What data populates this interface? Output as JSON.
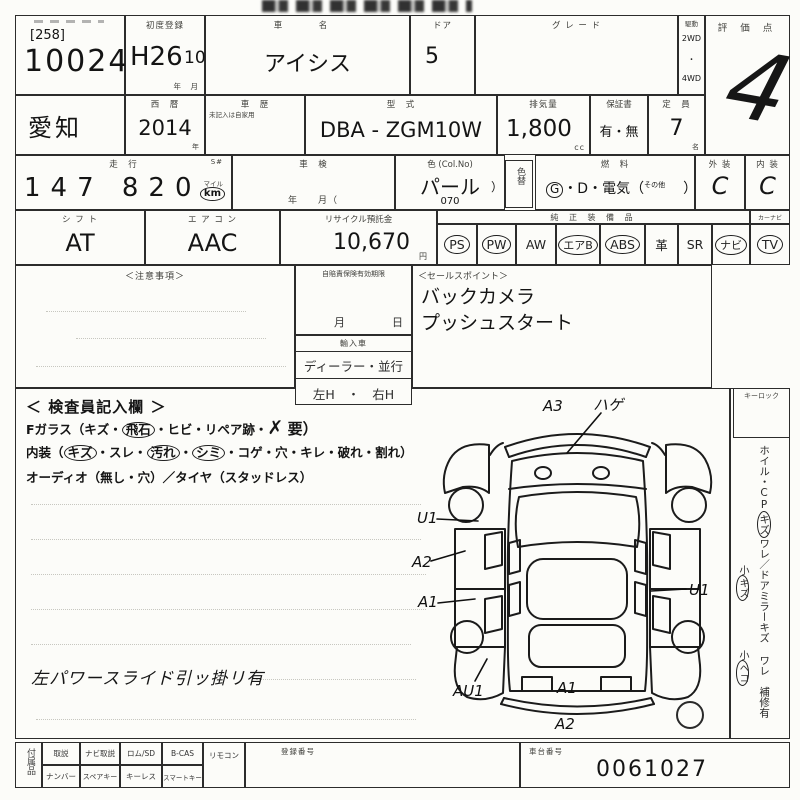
{
  "top": {
    "lot_small": "[258]",
    "lot": "10024",
    "first_reg_label": "初度登録",
    "first_reg_era": "H26",
    "first_reg_month": "10",
    "first_reg_units": "年　月",
    "car_name_label": "車　名",
    "car_name": "アイシス",
    "door_label": "ドア",
    "door": "5",
    "grade_label": "グ レ ー ド",
    "drive_label": "駆動",
    "drive_2wd": "2WD",
    "drive_dot": "・",
    "drive_4wd": "4WD",
    "score_label": "評 価 点",
    "score": "4"
  },
  "row2": {
    "region": "愛知",
    "year_label": "西　暦",
    "year": "2014",
    "year_unit": "年",
    "history_label": "車　歴",
    "history_note": "未記入は自家用",
    "model_label": "型　式",
    "model": "DBA - ZGM10W",
    "cc_label": "排気量",
    "cc": "1,800",
    "cc_unit": "cc",
    "warranty_label": "保証書",
    "warranty": "有・無",
    "capacity_label": "定　員",
    "capacity": "7",
    "capacity_unit": "名"
  },
  "row3": {
    "mileage_label": "走　行",
    "s_label": "S#",
    "mileage": "147 820",
    "mile_small": "マイル",
    "km": "km",
    "shaken_label": "車　検",
    "shaken_units": "年　　月（",
    "color_label": "色 (Col.No)",
    "color": "パール",
    "color_no": "070",
    "color_paren": "）",
    "colorchg_label": "色替",
    "fuel_label": "燃　料",
    "fuel_g": "G",
    "fuel_rest": "・D・電気（",
    "fuel_other": "その他",
    "fuel_close": "）",
    "ext_label": "外 装",
    "ext": "C",
    "int_label": "内 装",
    "int": "C"
  },
  "row4": {
    "shift_label": "シ フ ト",
    "shift": "AT",
    "ac_label": "エ ア コ ン",
    "ac": "AAC",
    "recycle_label": "リサイクル預託金",
    "recycle": "10,670",
    "recycle_unit": "円",
    "equip_label": "純 正 装 備 品",
    "equip_extra_label": "カーナビ",
    "equip": [
      "PS",
      "PW",
      "AW",
      "エアB",
      "ABS",
      "革",
      "SR",
      "ナビ",
      "TV"
    ]
  },
  "mid": {
    "notes_label": "＜注意事項＞",
    "expiry_label": "自賠責保険有効期限",
    "expiry_month": "月",
    "expiry_day": "日",
    "import_label": "輸入車",
    "import_opts": "ディーラー・並行",
    "import_handle": "左H　・　右H",
    "sales_label": "＜セールスポイント＞",
    "sales_1": "バックカメラ",
    "sales_2": "プッシュスタート"
  },
  "inspector": {
    "title": "＜ 検査員記入欄 ＞",
    "fglass_pre": "Fガラス（キズ・",
    "fglass_c1": "飛石",
    "fglass_mid": "・ヒビ・リペア跡・",
    "fglass_x": "✗",
    "fglass_end": "要）",
    "interior_pre": "内装（",
    "interior_c1": "キズ",
    "interior_m1": "・スレ・",
    "interior_c2": "汚れ",
    "interior_m2": "・",
    "interior_c3": "シミ",
    "interior_m3": "・コゲ・穴・キレ・破れ・割れ）",
    "audio_line": "オーディオ（無し・穴）／タイヤ（スタッドレス）",
    "note_hand": "左パワースライド引ッ掛リ有"
  },
  "sidebar": {
    "keylock": "キーロック",
    "v_main_1": "ホイル・CP",
    "v_main_c": "キズ",
    "v_main_2": "ワレ／ドアミラーキズ ワレ",
    "v_main_3": "補修有",
    "s1a": "小",
    "s1b": "キズ",
    "s2a": "小",
    "s2b": "ヘコ"
  },
  "diagram": {
    "marks": {
      "front_bumper": "A3",
      "hood": "ハゲ",
      "left_fender": "U1",
      "left_front_door": "A2",
      "left_rear_door": "A1",
      "left_quarter": "AU1",
      "right_side": "U1",
      "rear_gate": "A1",
      "rear_bumper": "A2"
    }
  },
  "bottom": {
    "acc_label": "付属品",
    "row1": [
      "取説",
      "ナビ取説",
      "ロム/SD",
      "B-CAS",
      "リモコン"
    ],
    "row2": [
      "ナンバー",
      "スペアキー",
      "キーレス",
      "スマートキー"
    ],
    "reg_label": "登録番号",
    "chassis_label": "車台番号",
    "chassis": "0061027"
  }
}
